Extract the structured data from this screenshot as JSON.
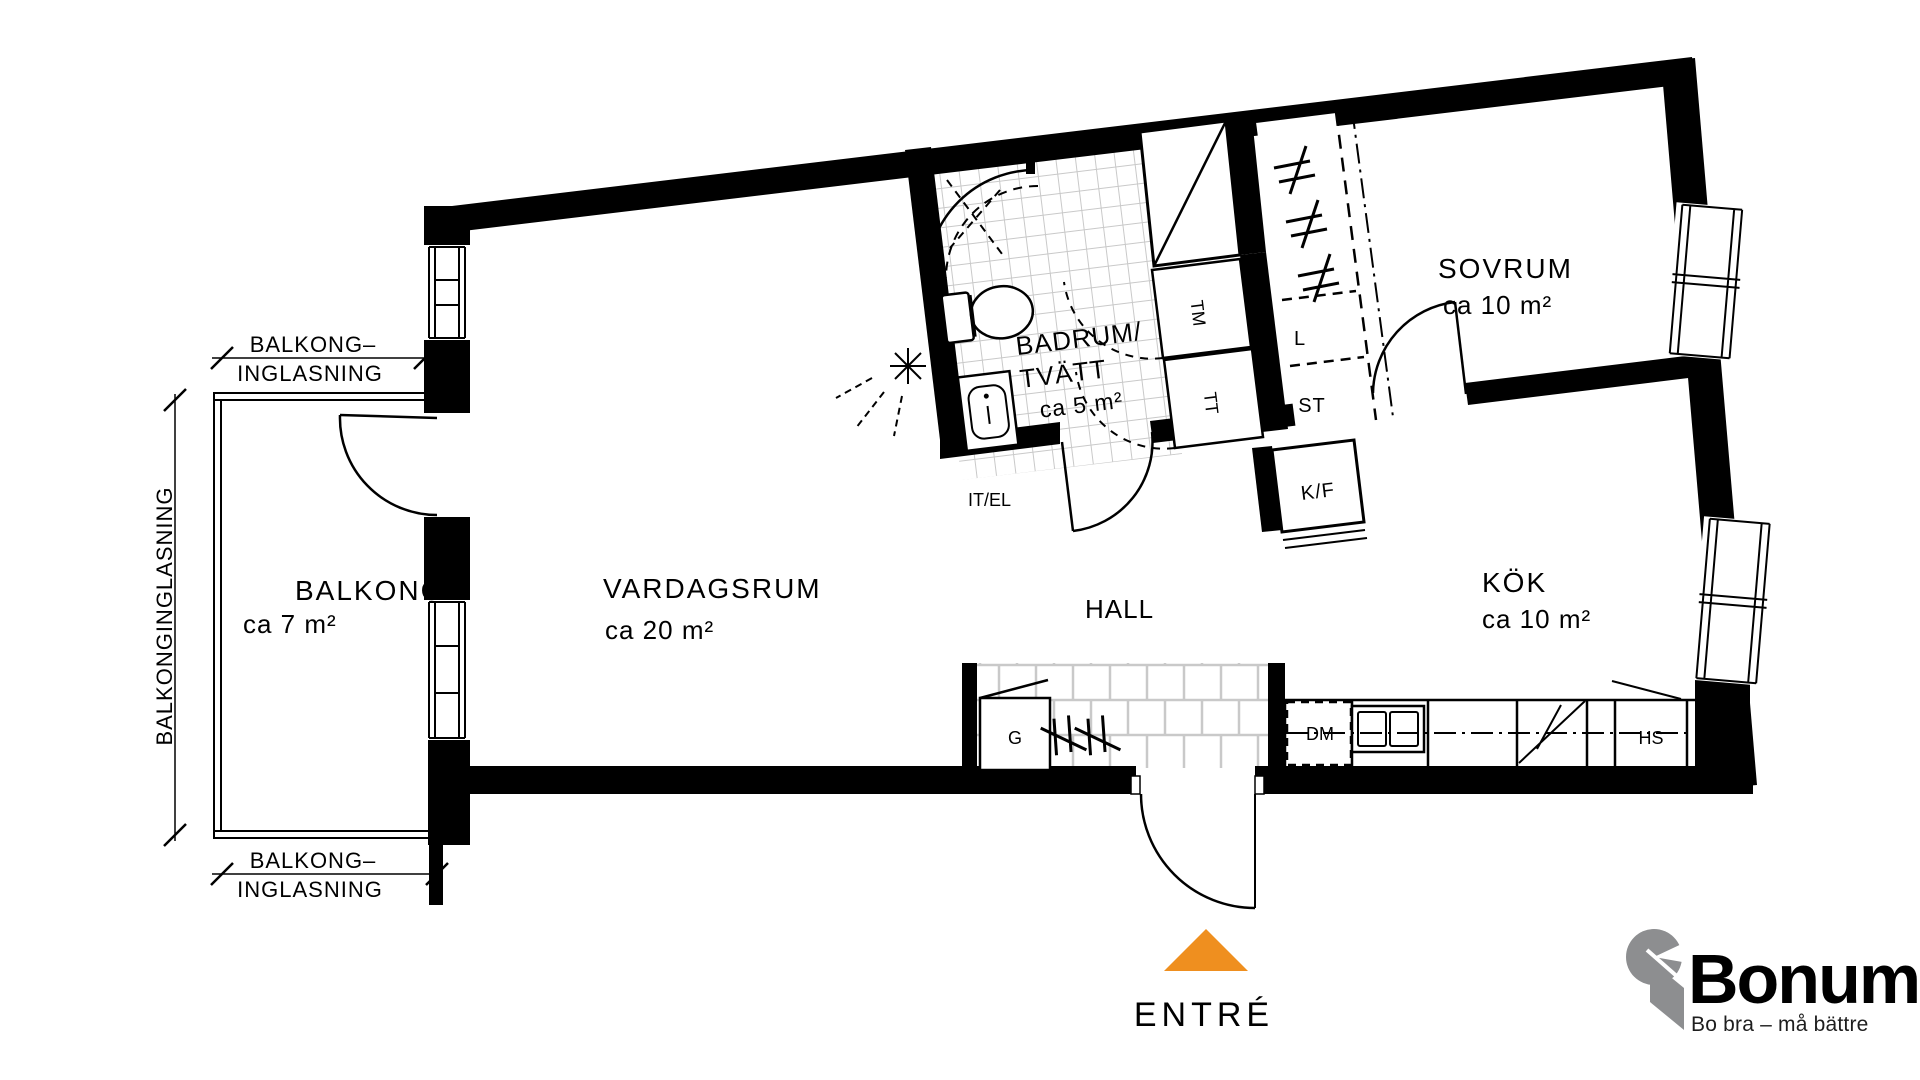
{
  "plan": {
    "rooms": {
      "balkong": {
        "name": "BALKONG",
        "area": "ca 7 m²"
      },
      "vardagsrum": {
        "name": "VARDAGSRUM",
        "area": "ca 20 m²"
      },
      "badrum": {
        "name_line1": "BADRUM/",
        "name_line2": "TVÄTT",
        "area": "ca 5 m²"
      },
      "sovrum": {
        "name": "SOVRUM",
        "area": "ca 10 m²"
      },
      "kok": {
        "name": "KÖK",
        "area": "ca 10 m²"
      },
      "hall": {
        "name": "HALL"
      }
    },
    "fixtures": {
      "tm": "TM",
      "tt": "TT",
      "l": "L",
      "st": "ST",
      "kf": "K/F",
      "it_el": "IT/EL",
      "g": "G",
      "dm": "DM",
      "hs": "HS"
    },
    "dimensions": {
      "top_label_line1": "BALKONG–",
      "top_label_line2": "INGLASNING",
      "left_label": "BALKONGINGLASNING",
      "bottom_label_line1": "BALKONG–",
      "bottom_label_line2": "INGLASNING"
    },
    "entrance": {
      "label": "ENTRÉ"
    },
    "logo": {
      "brand": "Bonum",
      "tagline": "Bo bra – må bättre"
    },
    "colors": {
      "wall": "#000000",
      "tile_line": "#C9C9C9",
      "appliance_arc": "#B3B3B3",
      "entrance_arrow": "#EF8F1F",
      "brand_orange": "#F5A11E",
      "brand_gray": "#8D8E90",
      "background": "#FFFFFF"
    }
  }
}
